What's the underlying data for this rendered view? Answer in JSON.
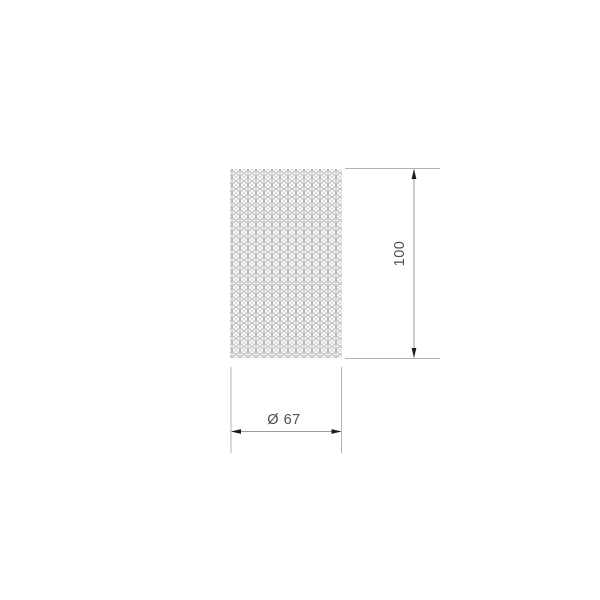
{
  "drawing": {
    "height_dimension": {
      "label": "100"
    },
    "diameter_dimension": {
      "label": "Ø 67"
    },
    "body_texture": "crystal-bead-grid"
  },
  "colors": {
    "background": "#ffffff",
    "extension_line": "#b3b3b3",
    "dimension_line": "#9b9b9b",
    "arrow": "#1d1d1d",
    "texture_stroke": "#b0b0b0",
    "label_text": "#4e4e4e"
  }
}
